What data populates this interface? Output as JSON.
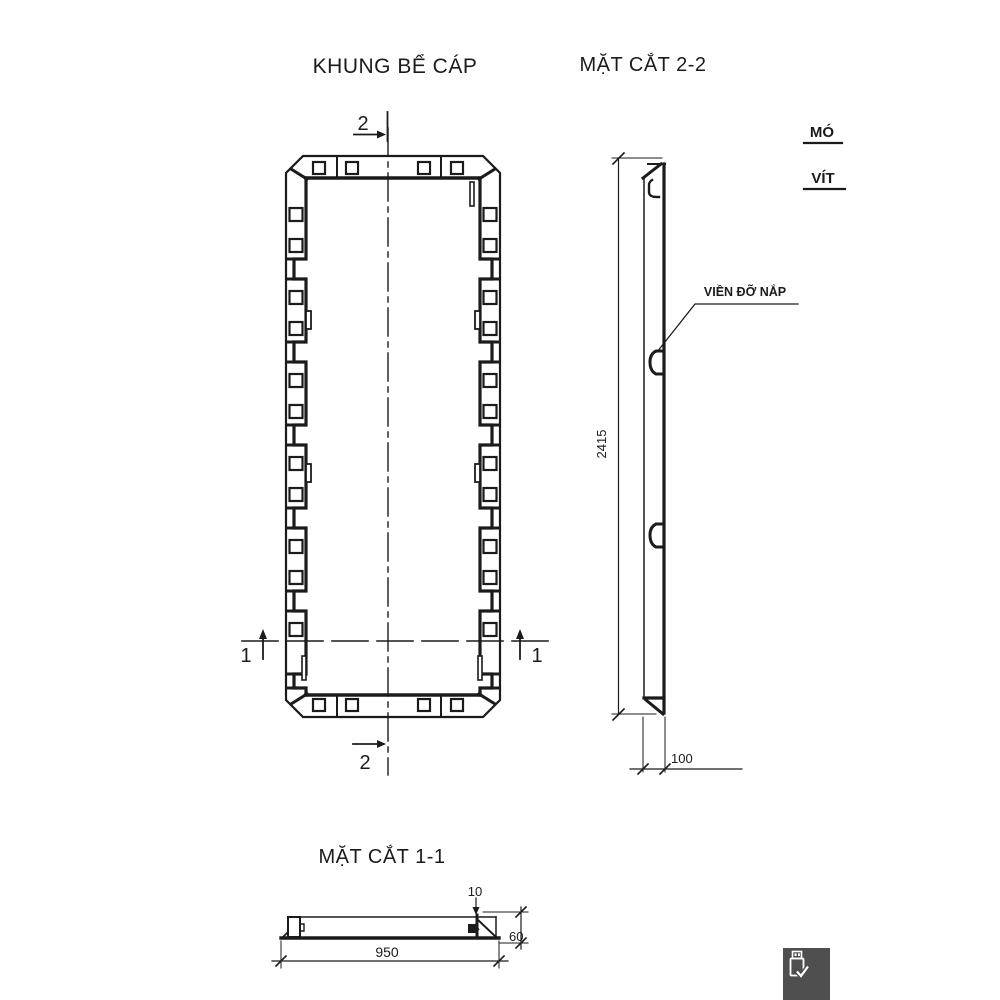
{
  "drawing": {
    "line_color": "#1b1b1b",
    "plan": {
      "title": "KHUNG BỂ CÁP",
      "marker_top": "2",
      "marker_bottom": "2",
      "marker_left": "1",
      "marker_right": "1"
    },
    "section22": {
      "title": "MẶT CẮT 2-2",
      "height_dim": "2415",
      "depth_dim": "100",
      "callout_label": "VIỀN ĐỠ NẮP",
      "note_line1": "MÓ",
      "note_line2": "VÍT"
    },
    "section11": {
      "title": "MẶT CẮT 1-1",
      "width_dim": "950",
      "plate_dim": "10",
      "height_dim": "60"
    }
  },
  "floating_button": {
    "icon": "usb-drive-check-icon",
    "background": "#4f4f4f"
  }
}
